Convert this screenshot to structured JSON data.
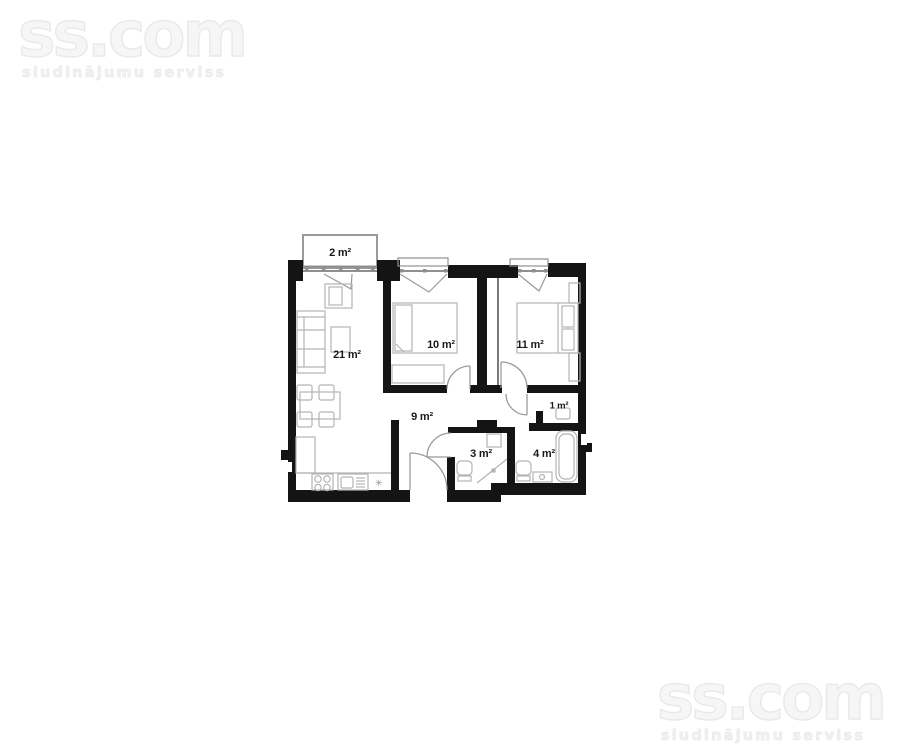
{
  "watermark": {
    "logo": "ss.com",
    "tagline": "sludinājumu serviss"
  },
  "floor_plan": {
    "title": "apartment-floor-plan",
    "rooms": [
      {
        "name": "balcony",
        "area_label": "2 m²"
      },
      {
        "name": "living-room-kitchen",
        "area_label": "21 m²"
      },
      {
        "name": "bedroom-1",
        "area_label": "10 m²"
      },
      {
        "name": "bedroom-2",
        "area_label": "11 m²"
      },
      {
        "name": "hallway",
        "area_label": "9 m²"
      },
      {
        "name": "closet",
        "area_label": "1 m²"
      },
      {
        "name": "wc",
        "area_label": "3 m²"
      },
      {
        "name": "bathroom",
        "area_label": "4 m²"
      }
    ],
    "symbols": {
      "vent": "✳"
    },
    "colors": {
      "wall": "#141414",
      "furniture_line": "#b3b3b3",
      "window_line": "#8f8f8f",
      "door_line": "#9a9a9a",
      "watermark": "#e9e9e9",
      "label_text": "#1a1a1a"
    }
  }
}
